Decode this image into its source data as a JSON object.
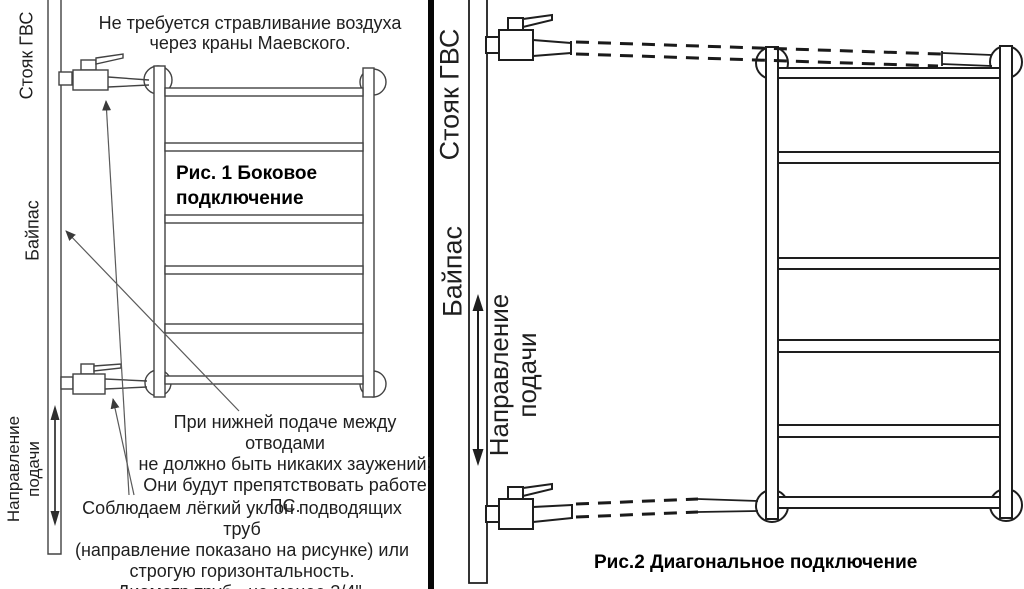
{
  "left_panel": {
    "riser_label": "Стояк ГВС",
    "bypass_label": "Байпас",
    "flow_label_line1": "Направление",
    "flow_label_line2": "подачи",
    "top_note_line1": "Не требуется стравливание воздуха",
    "top_note_line2": "через краны Маевского.",
    "figure_caption_line1": "Рис. 1 Боковое",
    "figure_caption_line2": "подключение",
    "mid_note_line1": "При нижней подаче между отводами",
    "mid_note_line2": "не должно быть никаких заужений!",
    "mid_note_line3": "Они будут препятствовать работе ПС.",
    "bottom_note_line1": "Соблюдаем лёгкий уклон подводящих труб",
    "bottom_note_line2": "(направление показано на рисунке) или",
    "bottom_note_line3": "строгую горизонтальность.",
    "bottom_note_line4": "Диаметр труб - не менее 3/4\"."
  },
  "right_panel": {
    "riser_label": "Стояк ГВС",
    "bypass_label": "Байпас",
    "flow_label_line1": "Направление",
    "flow_label_line2": "подачи",
    "figure_caption": "Рис.2 Диагональное подключение"
  },
  "colors": {
    "background": "#ffffff",
    "left_line": "#424242",
    "right_line": "#1e1e1e",
    "divider": "#060606",
    "text": "#1f1f1f"
  }
}
